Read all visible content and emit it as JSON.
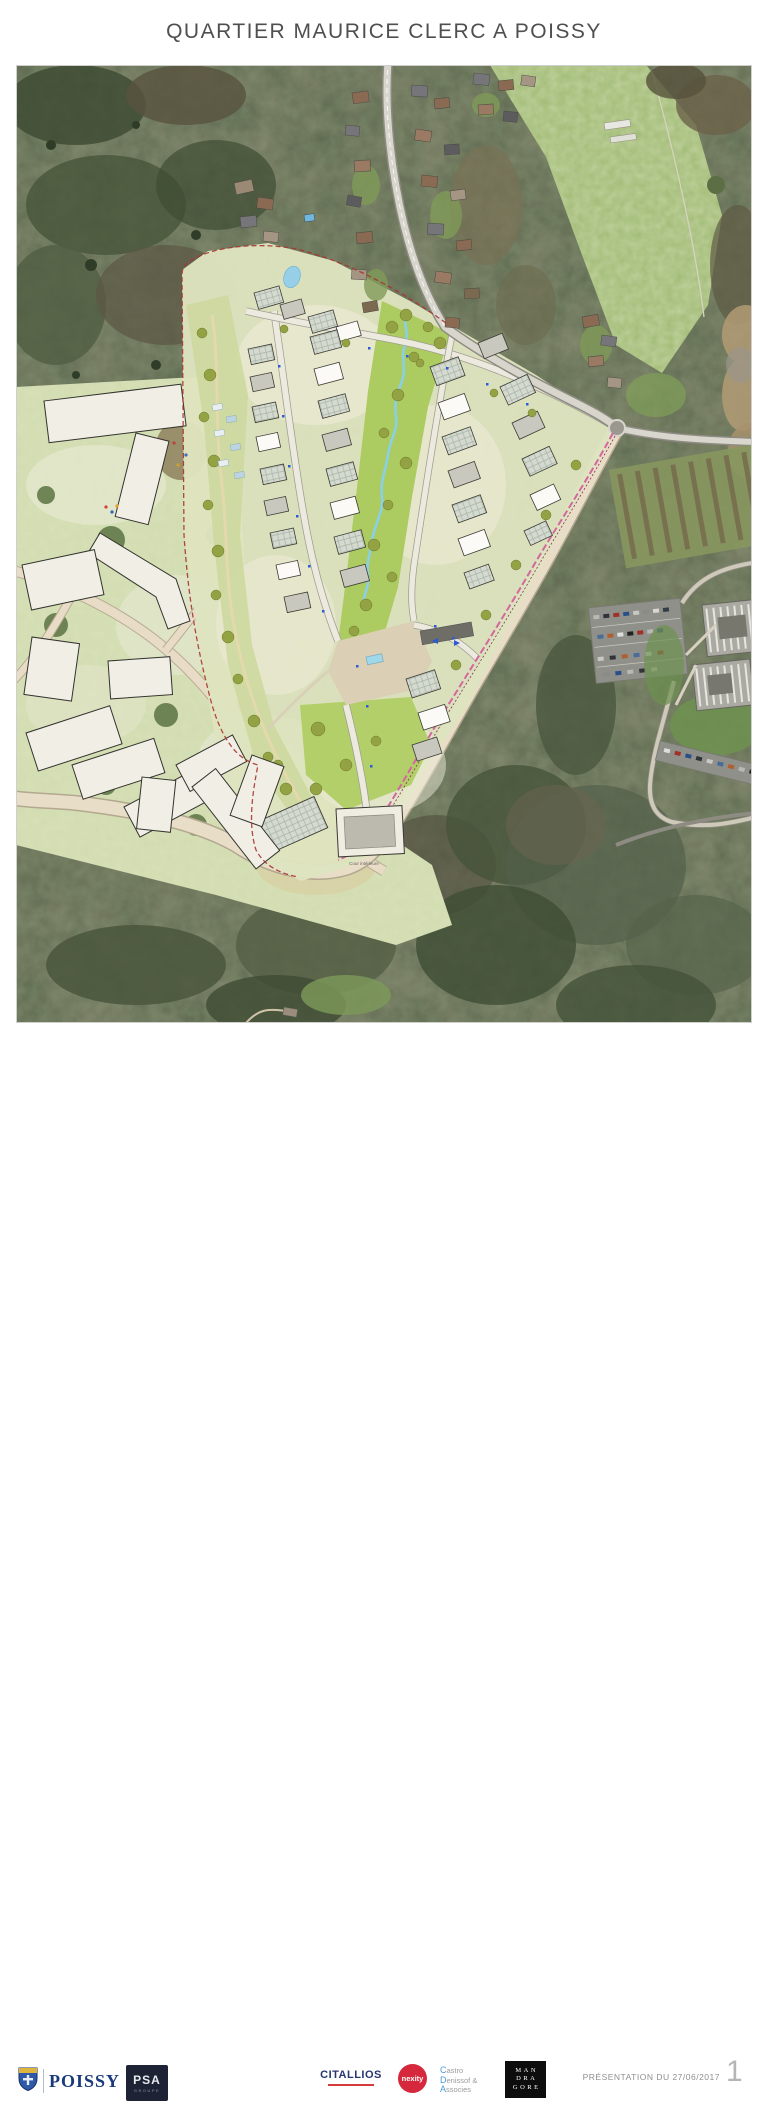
{
  "title": "QUARTIER MAURICE CLERC A POISSY",
  "map": {
    "courtyard_label": "Cour intérieure"
  },
  "footer": {
    "poissy_label": "POISSY",
    "psa_label": "PSA",
    "psa_sub": "GROUPE",
    "citallios_label": "CITALLIOS",
    "nexity_label": "nexity",
    "castro_lines": [
      "Castro",
      "Denissof &",
      "Associes"
    ],
    "mandragore_lines": [
      "MAN",
      "DRA",
      "GORE"
    ],
    "presentation_label": "PRÉSENTATION DU 27/06/2017",
    "page_number": "1"
  },
  "colors": {
    "poissy_blue": "#1a3a7c",
    "psa_navy": "#1d2335",
    "citallios_blue": "#253671",
    "citallios_red": "#d43b3b",
    "nexity_red": "#d6283c",
    "castro_blue": "#4a9bd4",
    "mandragore_black": "#0d0d0d",
    "site_boundary_red": "#a83532",
    "tram_pink": "#d4679f",
    "park_green": "#accb60",
    "stream_blue": "#8ad0e6"
  }
}
